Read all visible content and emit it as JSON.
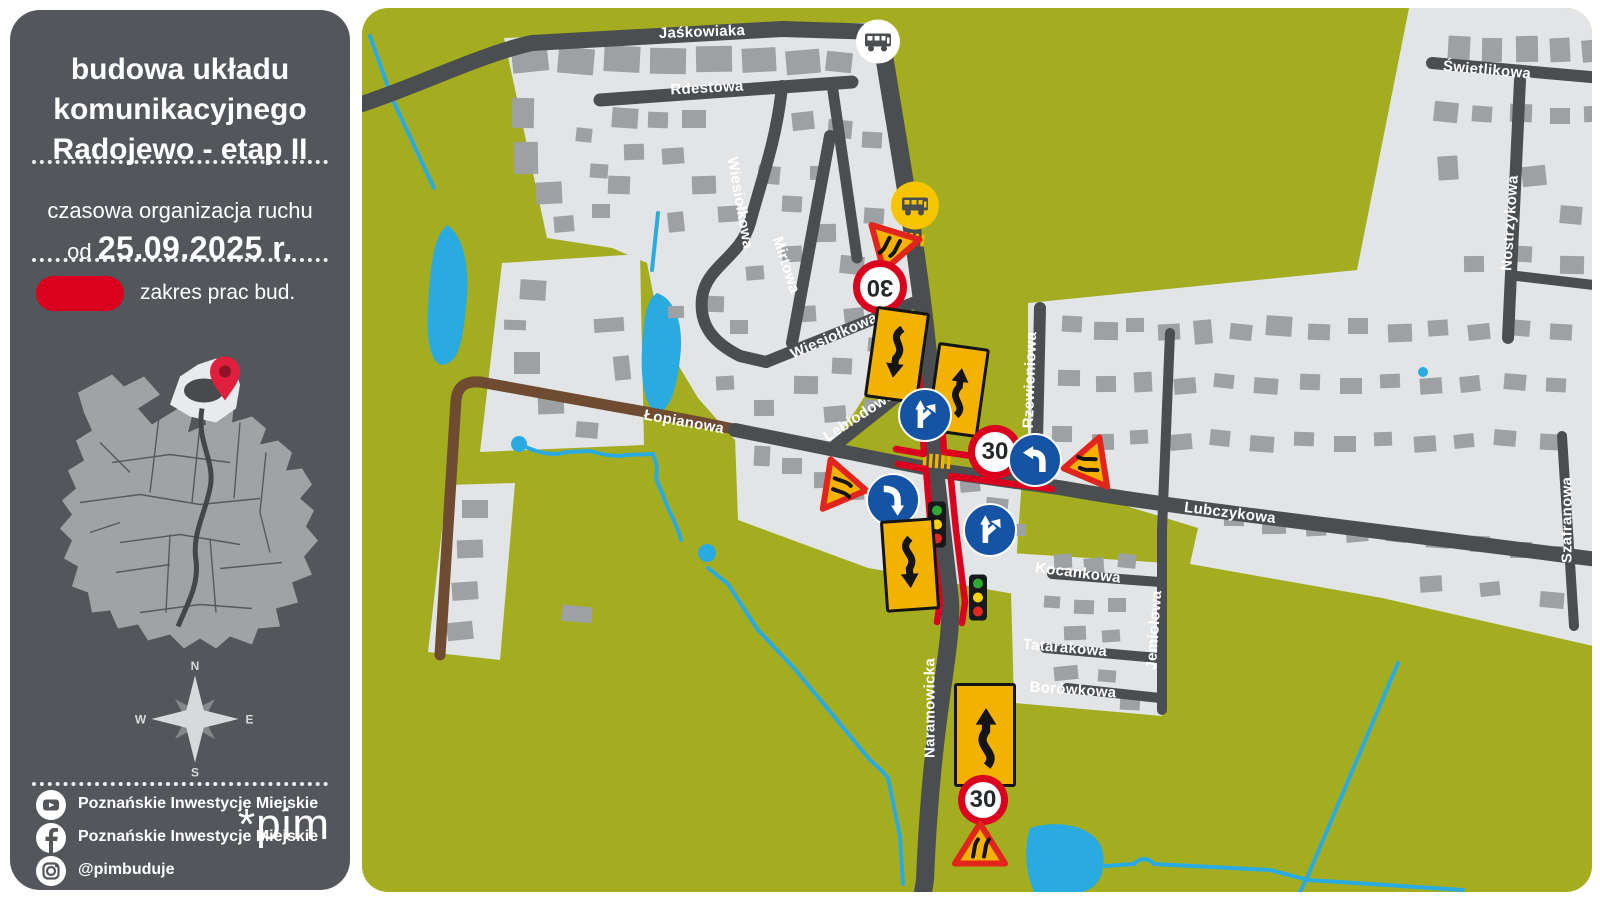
{
  "sidebar": {
    "title_lines": [
      "budowa układu",
      "komunikacyjnego",
      "Radojewo - etap II"
    ],
    "subtitle": "czasowa organizacja ruchu",
    "date_prefix": "od",
    "date": "25.09.2025 r.",
    "legend_label": "zakres prac bud.",
    "compass": {
      "n": "N",
      "e": "E",
      "s": "S",
      "w": "W"
    },
    "social": {
      "youtube": "Poznańskie Inwestycje Miejskie",
      "facebook": "Poznańskie Inwestycje Miejskie",
      "instagram": "@pimbuduje"
    },
    "logo": "*pim"
  },
  "map": {
    "streets": {
      "jaskowiaka": "Jaśkowiaka",
      "rdestowa": "Rdestowa",
      "wiesiolkowa1": "Wiesiołkowa",
      "mirtowa": "Mirtowa",
      "wiesiolkowa2": "Wiesiołkowa",
      "radojewo": "Radojewo",
      "lopianowa": "Łopianowa",
      "lebiodowa": "Lebiodowa",
      "rzewieniowa": "Rzewieniowa",
      "lubczykowa": "Lubczykowa",
      "kocankowa": "Kocankowa",
      "jemiolowa": "Jemiołowa",
      "tatarakowa": "Tatarakowa",
      "borowkowa": "Borówkowa",
      "naramowicka": "Naramowicka",
      "swietlikowa": "Świetlikowa",
      "nostrzykowa": "Nostrzykowa",
      "szafranowa": "Szafranowa"
    },
    "signs": {
      "speed_limit": "30"
    },
    "colors": {
      "work_zone_red": "#d9011d",
      "map_green": "#a4ad20",
      "water_blue": "#29abe2",
      "road_gray": "#4b4e51",
      "dirt_brown": "#6e4b31",
      "sign_yellow": "#f3b200",
      "sign_blue": "#1553a4"
    }
  }
}
